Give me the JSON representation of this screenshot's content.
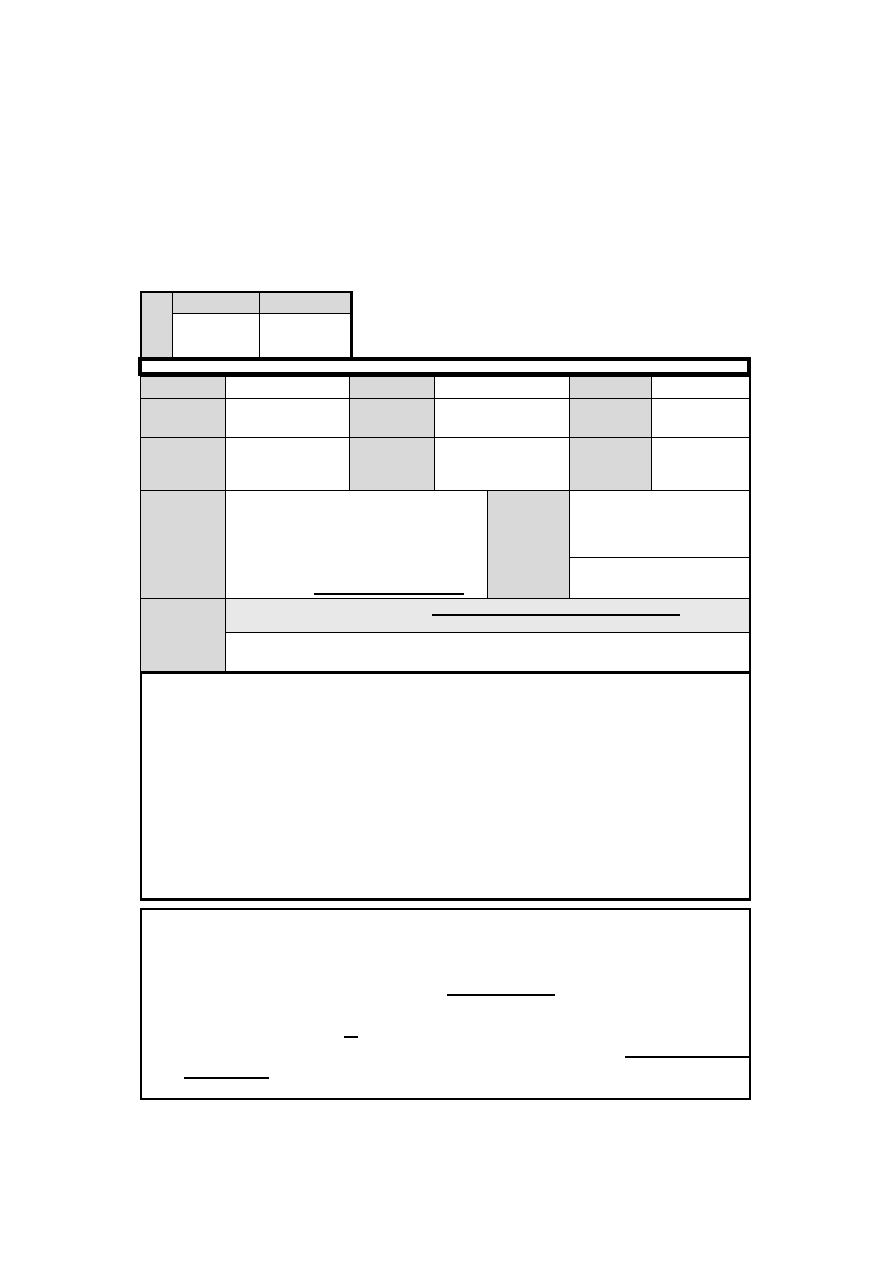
{
  "colors": {
    "page_background": "#ffffff",
    "label_cell_shading": "#d9d9d9",
    "highlight_row_shading": "#e8e8e8",
    "border": "#000000"
  },
  "top_table": {
    "corner_cell": "",
    "headers": [
      "",
      ""
    ],
    "values": [
      "",
      ""
    ]
  },
  "section_bar": {
    "title": ""
  },
  "main_table": {
    "rows_1_to_3": [
      {
        "label_a": "",
        "value_a": "",
        "label_b": "",
        "value_b": "",
        "label_c": "",
        "value_c": ""
      },
      {
        "label_a": "",
        "value_a": "",
        "label_b": "",
        "value_b": "",
        "label_c": "",
        "value_c": ""
      },
      {
        "label_a": "",
        "value_a": "",
        "label_b": "",
        "value_b": "",
        "label_c": "",
        "value_c": ""
      }
    ],
    "row_4": {
      "label": "",
      "main_value": "",
      "mid_label": "",
      "right_top_value": "",
      "right_bottom_value": ""
    },
    "row_5": {
      "label": "",
      "highlight_value": "",
      "bottom_value": ""
    }
  },
  "notes_box": {
    "content": ""
  },
  "certification_box": {
    "content": "",
    "blank_line_count": 4
  }
}
